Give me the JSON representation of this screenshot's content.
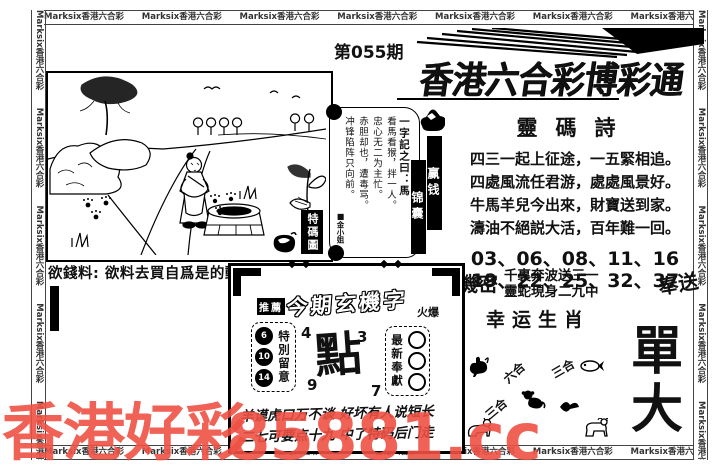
{
  "border": {
    "marquee_text": "Marksix香港六合彩"
  },
  "masthead": {
    "issue": "第055期",
    "title": "香港六合彩博彩通"
  },
  "picture": {
    "stamp": "特碼圖",
    "caption": "欲錢料: 欲料去買自爲是的動物"
  },
  "scroll": {
    "columns": [
      "一字記之曰：馬",
      "看馬看猴，拌一人。",
      "忠心无二为主忙。",
      "赤胆却也，遭毒骂。",
      "冲锋陷阵只向前。"
    ],
    "signature": "金小姐"
  },
  "ribbons": {
    "first": "赢钱",
    "second": "锦囊"
  },
  "poem": {
    "title": "靈碼詩",
    "lines": [
      "四三一起上征途，一五緊相追。",
      "四處風流任君游，處處風景好。",
      "牛馬羊兒今出來，財寶送到家。",
      "濤油不絕説大活，百年難一回。"
    ],
    "numbers_line1": "03、06、08、11、16",
    "numbers_line2": "19、22、25、32、37"
  },
  "secret": {
    "left": "機密",
    "line1": "千裏奔波送三一",
    "line2": "靈蛇現身二九中",
    "right": "奉送"
  },
  "lucky": {
    "heading": "幸运生肖",
    "labels": [
      "六合",
      "三合",
      "三合"
    ],
    "big_char_1": "單",
    "big_char_2": "大"
  },
  "mystery_box": {
    "pre_label": "推薦",
    "title": "今期玄機字",
    "tag": "火爆",
    "badge_left": {
      "label": "特別留意",
      "numbers": [
        "6",
        "10",
        "14"
      ]
    },
    "badge_right": {
      "label": "最新奉獻",
      "numbers": [
        "",
        "",
        ""
      ]
    },
    "big_char": "點",
    "corner_numbers": [
      "4",
      "3",
      "9",
      "7"
    ],
    "line1": "羊谟虎口万不谈 好坏有人说短长",
    "line2": "二七可要点十九 中了特码后门走"
  },
  "watermark": {
    "text1": "香港好彩",
    "text2": "85881.cc",
    "color": "#ee5044"
  }
}
